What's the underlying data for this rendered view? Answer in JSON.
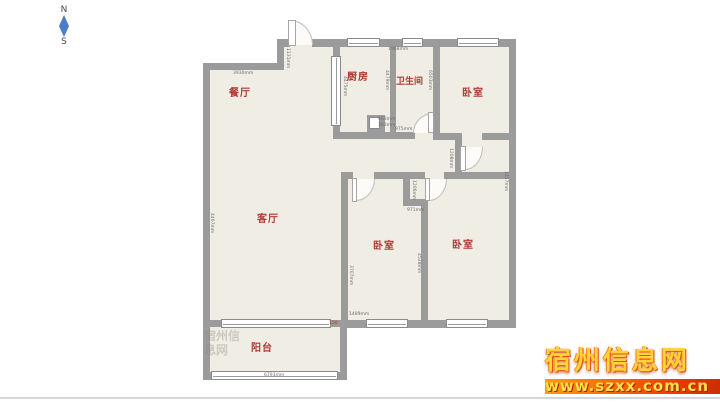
{
  "compass": {
    "north": "N",
    "south": "S"
  },
  "rooms": [
    {
      "id": "dining",
      "label": "餐厅"
    },
    {
      "id": "kitchen",
      "label": "厨房"
    },
    {
      "id": "bathroom",
      "label": "卫生间"
    },
    {
      "id": "bedroom-top-right",
      "label": "卧室"
    },
    {
      "id": "living",
      "label": "客厅"
    },
    {
      "id": "bedroom-bottom-left",
      "label": "卧室"
    },
    {
      "id": "bedroom-bottom-right",
      "label": "卧室"
    },
    {
      "id": "balcony",
      "label": "阳台"
    }
  ],
  "dims": {
    "dining_width": "3930mm",
    "entry_step": "1131mm",
    "kitchen_left": "4475mm",
    "kitchen_top": "1968mm",
    "kitchen_right": "4479mm",
    "bath_right": "6503mm",
    "bath_bottom": "975mm",
    "flue_w": "463mm",
    "flue_h": "363mm",
    "hall_stub": "1208mm",
    "notch_height": "1206mm",
    "notch_width": "971mm",
    "living_left": "4467mm",
    "hall_right": "1457mm",
    "bedroom_bl_left": "3707mm",
    "bedroom_divider": "4528mm",
    "window_mid": "1489mm",
    "balcony_width": "6793mm",
    "red_mark": "150"
  },
  "watermark": {
    "site_name": "宿州信息网",
    "site_url": "www.szxx.com.cn"
  },
  "faint_watermark": {
    "text": "宿州信息网"
  },
  "colors": {
    "wall": "#9b9b9b",
    "floor": "#f0ede4",
    "room_label": "#b03a36",
    "compass_arrow": "#4a7cc9",
    "watermark_text": "#ffd23e",
    "watermark_bar_start": "#ff9b13",
    "watermark_bar_end": "#c22a00",
    "bottom_line": "#d4d7da"
  }
}
